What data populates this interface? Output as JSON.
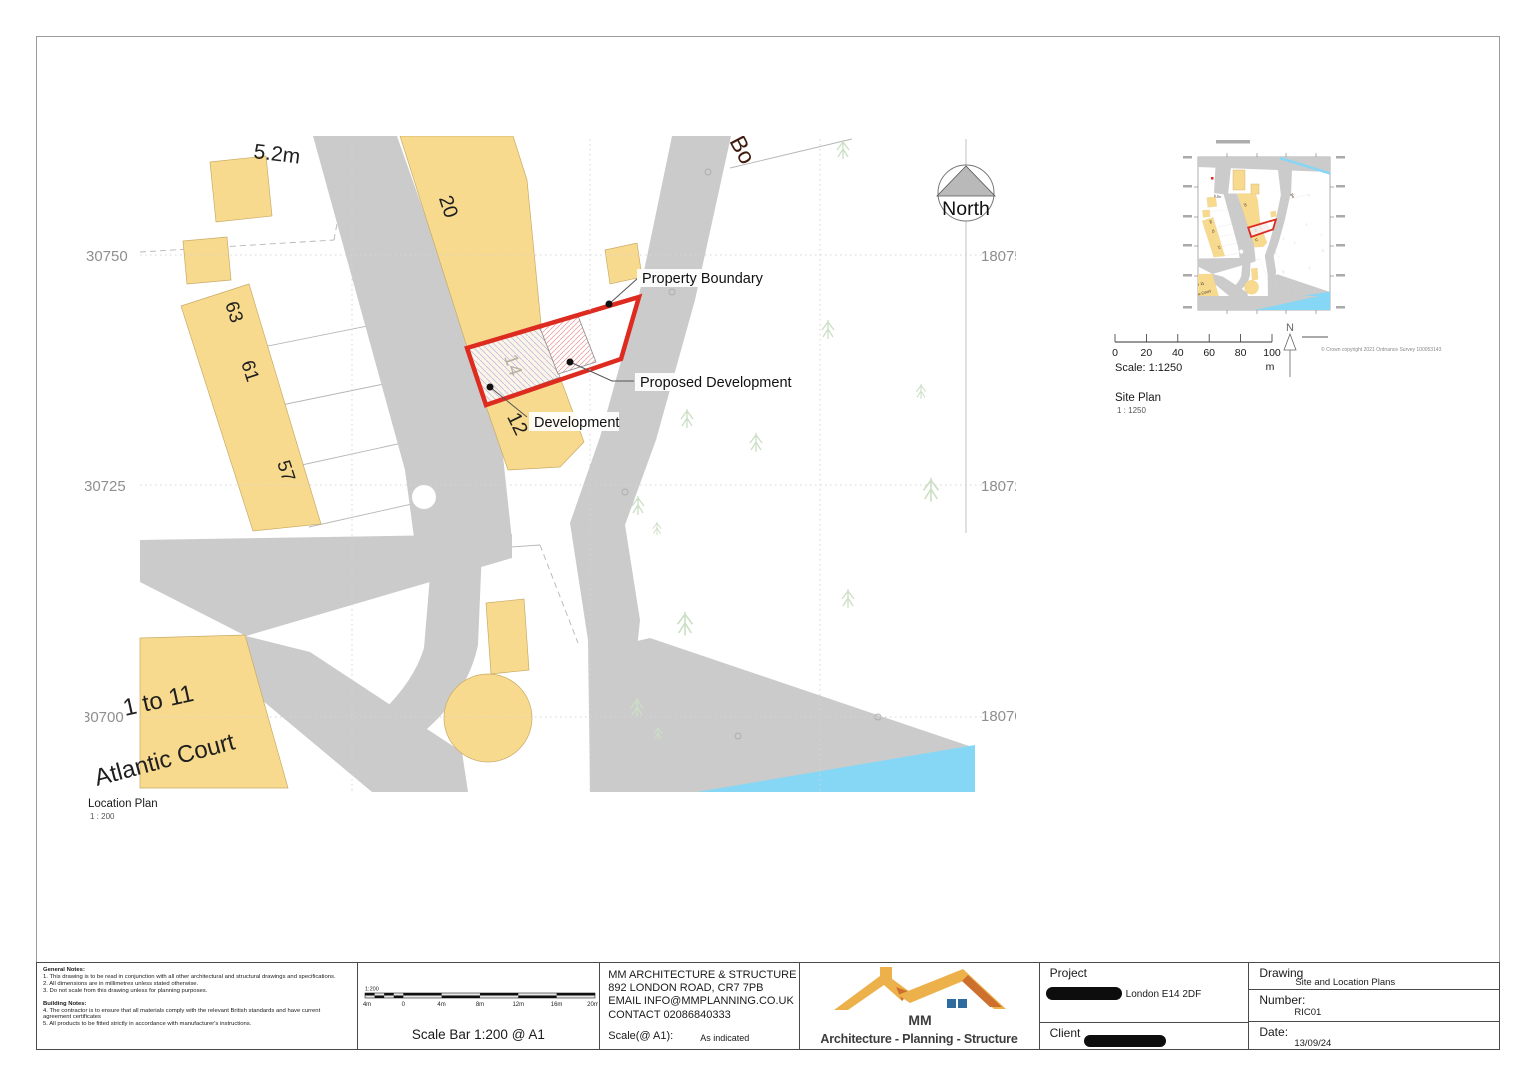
{
  "location_plan": {
    "caption": "Location Plan",
    "caption_scale": "1 : 200",
    "north_label": "North",
    "dimension_label": "5.2m",
    "street_label": "Bo",
    "building_numbers": {
      "b20": "20",
      "b63": "63",
      "b61": "61",
      "b57": "57",
      "b14": "14",
      "b12": "12"
    },
    "atlantic": {
      "line1": "1 to 11",
      "line2": "Atlantic Court"
    },
    "annotations": {
      "property_boundary": "Property Boundary",
      "proposed_development": "Proposed Development",
      "development": "Development"
    },
    "grid_left": [
      "30750",
      "30725",
      "30700"
    ],
    "grid_right": [
      "180750",
      "180725",
      "180700"
    ]
  },
  "site_plan": {
    "caption": "Site Plan",
    "caption_scale": "1 : 1250",
    "scale_text": "Scale: 1:1250",
    "ticks": [
      "0",
      "20",
      "40",
      "60",
      "80",
      "100"
    ],
    "unit": "m",
    "north_letter": "N",
    "copyright": "© Crown copyright 2021 Ordnance Survey 100053143"
  },
  "title_block": {
    "general_notes_heading": "General Notes:",
    "general_notes": [
      "1. This drawing is to be read in conjunction with all other architectural and structural drawings and specifications.",
      "2. All dimensions are in millimetres unless stated otherwise.",
      "3. Do not scale from this drawing unless for planning purposes."
    ],
    "building_notes_heading": "Building Notes:",
    "building_notes": [
      "4. The contractor is to ensure that all materials comply with the relevant British standards and have current",
      "agreement certificates",
      "5. All products to be fitted strictly in accordance with manufacturer's instructions."
    ],
    "scale_bar": {
      "ratio": "1:200",
      "ticks": [
        "4m",
        "0",
        "4m",
        "8m",
        "12m",
        "16m",
        "20m"
      ],
      "caption": "Scale Bar 1:200 @ A1"
    },
    "company": {
      "name": "MM ARCHITECTURE & STRUCTURE",
      "address": "892 LONDON ROAD, CR7 7PB",
      "email": "EMAIL INFO@MMPLANNING.CO.UK",
      "contact": "CONTACT 02086840333",
      "scale_label": "Scale(@ A1):",
      "scale_value": "As indicated"
    },
    "logo": {
      "name": "MM",
      "tagline": "Architecture - Planning - Structure"
    },
    "project": {
      "label": "Project",
      "address": "London E14 2DF"
    },
    "client": {
      "label": "Client"
    },
    "drawing": {
      "label": "Drawing",
      "value": "Site and Location Plans"
    },
    "number": {
      "label": "Number:",
      "value": "RIC01"
    },
    "date": {
      "label": "Date:",
      "value": "13/09/24"
    }
  },
  "colors": {
    "road": "#cbcbcb",
    "building": "#f7da8e",
    "water": "#86d7f5",
    "boundary_red": "#dd2b20",
    "tree": "#ccdfc5",
    "logo_yellow": "#edb14c",
    "logo_orange": "#cd6f2d",
    "logo_blue": "#2e6b9e"
  }
}
